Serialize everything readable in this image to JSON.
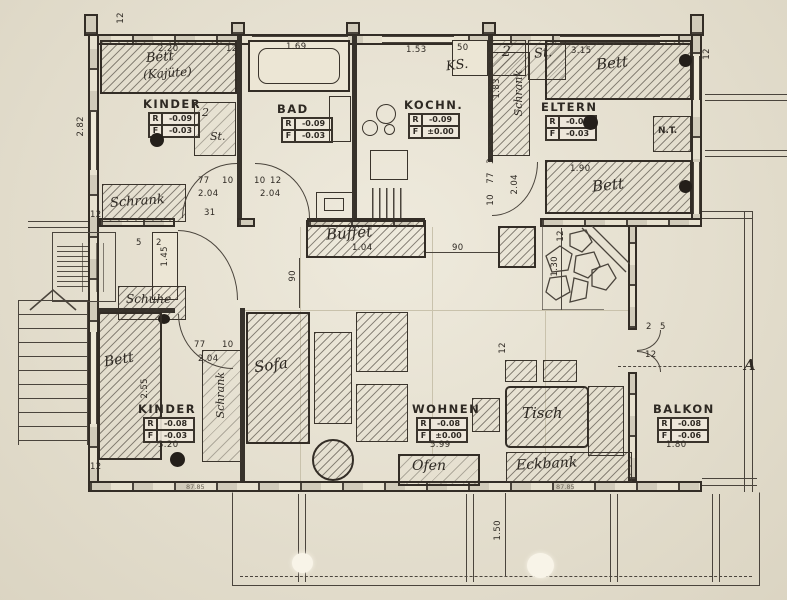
{
  "drawing": {
    "kind": "log-house floor plan, scanned hand drawing"
  },
  "rf": {
    "r": "R",
    "f": "F"
  },
  "rooms": {
    "kinder_top": {
      "name": "KINDER",
      "r": "-0.09",
      "f": "-0.03"
    },
    "bad": {
      "name": "BAD",
      "r": "-0.09",
      "f": "-0.03"
    },
    "kochnische": {
      "name": "KOCHN.",
      "r": "-0.09",
      "f": "±0.00"
    },
    "eltern": {
      "name": "ELTERN",
      "r": "-0.09",
      "f": "-0.03"
    },
    "kinder_bottom": {
      "name": "KINDER",
      "r": "-0.08",
      "f": "-0.03"
    },
    "wohnen": {
      "name": "WOHNEN",
      "r": "-0.08",
      "f": "±0.00"
    },
    "balkon": {
      "name": "BALKON",
      "r": "-0.08",
      "f": "-0.06"
    }
  },
  "furniture": {
    "bett": "Bett",
    "kajuete": "(Kajüte)",
    "schrank": "Schrank",
    "schuhe": "Schuhe",
    "sofa": "Sofa",
    "tisch": "Tisch",
    "eckbank": "Eckbank",
    "ofen": "Ofen",
    "buffet": "Buffet",
    "ks": "KS.",
    "st": "St.",
    "zwei": "2",
    "nt": "N.T.",
    "section_a": "A"
  },
  "dims": {
    "twelve": "12",
    "kajuete_w": "2.20",
    "bad_w": "1.69",
    "kochn_w": "1.53",
    "ks_w": "50",
    "bett_eltern_top": "3.15",
    "kinder_h": "2.82",
    "schrank_eltern": "1.83",
    "bett_eltern_bottom": "1.90",
    "door_w": "77",
    "door_f": "10",
    "door_2": "2.04",
    "three": "3",
    "five": "5",
    "two": "2",
    "thirty_one": "31",
    "entry": "1.45",
    "ninety": "90",
    "buffet_l": "1.04",
    "fire_h": "1.30",
    "bett_kinder": "2.55",
    "kinder_w": "3.20",
    "wohnen_l": "5.99",
    "balkon_w": "1.80",
    "terrace_d": "1.50",
    "stamp": "87.85"
  },
  "colors": {
    "paper": "#e9e3d1",
    "ink": "#37322b"
  }
}
